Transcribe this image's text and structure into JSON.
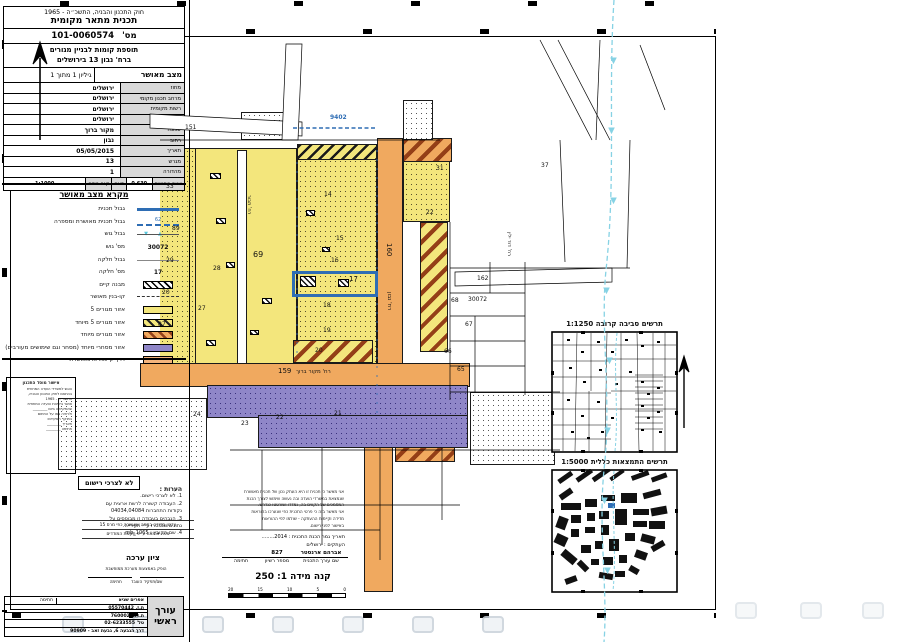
{
  "map_info": {
    "lines": [
      "מחוז :ירושלים",
      "נפה :ירושלים",
      "מקום : רחו' נבון,מס' 13",
      "גוש: 30072",
      "חלקה :17",
      "שטח מדוד : 0.110 ד'",
      "הוכן עבור : הבעלים"
    ]
  },
  "title_block": {
    "law": "חוק התכנון והבניה, התשכ״ה - 1965",
    "doc_type": "תכנית מתאר מקומית",
    "number_label": "מס'",
    "number": "101-0060574",
    "plan_name_1": "תוספת קומות לבניין מגורים",
    "plan_name_2": "ברח' נבון 13 בירושלים",
    "status": "מצב מאושר",
    "sheet": "גיליון 1 מתוך 1",
    "rows": [
      {
        "label": "מחוז",
        "value": "ירושלים"
      },
      {
        "label": "מרחב תכנון מקומי",
        "value": "ירושלים"
      },
      {
        "label": "רשות מקומית",
        "value": "ירושלים"
      },
      {
        "label": "ישוב",
        "value": "ירושלים"
      },
      {
        "label": "שכונה",
        "value": "מקור ברוך"
      },
      {
        "label": "רחוב",
        "value": "נבון"
      },
      {
        "label": "תאריך",
        "value": "05/05/2015"
      },
      {
        "label": "מגרש",
        "value": "13"
      },
      {
        "label": "מהדורה",
        "value": "1"
      }
    ],
    "area_label": "שטח התכנית",
    "area_value": "0.630",
    "area_unit": "דונם",
    "scale_label": "קנה מידה",
    "scale_value": "1:1000"
  },
  "legend": {
    "title": "מקרא מצב מאושר",
    "items": [
      {
        "s": "line-blue",
        "label": "גבול תכנית"
      },
      {
        "s": "dash-blue",
        "t": "62",
        "label": "גבול תכנית מאושרת ומספרה"
      },
      {
        "s": "gush",
        "t": "▲▼",
        "label": "גבול גוש"
      },
      {
        "s": "num",
        "t": "30072",
        "label": "מס' גוש"
      },
      {
        "s": "thin",
        "label": "גבול חלקה"
      },
      {
        "s": "num",
        "t": "17",
        "label": "מס' חלקה"
      },
      {
        "s": "box bldg",
        "label": "מבנה קיים"
      },
      {
        "s": "dashdot",
        "label": "קו-בנין מאושר"
      },
      {
        "s": "box y",
        "label": "אזור מגורים 5"
      },
      {
        "s": "box yh",
        "label": "אזור מגורים 5 מיוחד"
      },
      {
        "s": "box oh",
        "label": "אזור מגורים מיוחד"
      },
      {
        "s": "box p",
        "label": "אזור מסחרי מיוחד (מסחר וגם שימושים מעורבים)"
      },
      {
        "s": "box o",
        "label": "דרך קיימת או מאושרת"
      }
    ]
  },
  "stamp_box": {
    "title": "אישור מוסד התכנון",
    "lines": [
      "הוגש למשרדי הועדה המחוזית",
      "בהתאם לחוק התכנון והבניה,",
      "התשכ״ה - 1965",
      "אושר בישיבת הועדה המחוזית",
      "שהתקיימה ביום ________",
      "ולראיה באו על החתום",
      "בתוקף תפקידם:",
      "תאריך ________",
      "חתימה ________"
    ]
  },
  "notes": {
    "title": "הערות :",
    "lines": [
      "1. לא לצרכי רישום.",
      "2. העבודה קשורה לרשת ארצית עם",
      "נקודות התחברות 04034,04084",
      "3. הגבהים בעבודה זו מבוססים על",
      "נתונים שנמסרו ע״י העירייה.",
      "4. שם הקובץ : mb_1065"
    ]
  },
  "editor_table": {
    "header": "עורך ראשי",
    "name": "אפרים שגיא",
    "signature_label": "חתימה",
    "rows": [
      "ת.ז. 05570442",
      "ת.ד. 7600020",
      "טל' 02-6233555",
      "דרך הגבעה 6, גבעת זאב - 90909"
    ]
  },
  "insets": {
    "near_title": "תרשים סביבה קרובה 1:1250",
    "general_title": "תרשים התמצאות כללית 1:5000"
  },
  "no_registration": "לא לצרכי רישום",
  "survey_update": {
    "line1": "עדכון מדידה במפה שאושרה כפי מרס 15",
    "line2": "מפה אומתה ע״פ תקנות המודדים"
  },
  "zion": {
    "title": "ציון ערכה",
    "note": "הופק באמצעות מערכת ממוחשבת",
    "col_right": "שם/תפקיד העובד",
    "col_left": "חתימה"
  },
  "certification": {
    "lines": [
      "אני מאשר כי תכנית זו היא העתק נכון של תכנית מאושרת",
      "שנמצאת במשרדי הועדה ובה נעשה שימוש לצורך הכנת",
      "המסמכים של הקווים בה, נמדדו ושורטטו כנדרש.",
      "אני מאשר בזה כי פרטי התכנית כפי שנערכו בהוראות",
      "מדידה וקיימות ההעתקה - שולמו לפי ההוראות",
      "באישור לפני רישום."
    ]
  },
  "prep": {
    "date_label": "תאריך גמר הכנת התכנית :",
    "date_value": "2014........",
    "copies_label": "העתקים :",
    "copies_value": "ירושלים"
  },
  "sig": {
    "name": "אברהם ארנסטר",
    "name_label": "שם עורך התכנית",
    "license": "827",
    "license_label": "מספר רשיון",
    "sign_label": "חתימה"
  },
  "scale": {
    "title": "קנה מידה 1: 250",
    "ticks": [
      "20",
      "15",
      "10",
      "5",
      "0"
    ]
  },
  "map": {
    "labels": [
      {
        "t": "151",
        "x": 185,
        "y": 125
      },
      {
        "t": "9402",
        "x": 330,
        "y": 115,
        "c": "blue"
      },
      {
        "t": "33",
        "x": 166,
        "y": 184
      },
      {
        "t": "89",
        "x": 172,
        "y": 226
      },
      {
        "t": "29",
        "x": 166,
        "y": 258
      },
      {
        "t": "20",
        "x": 162,
        "y": 290
      },
      {
        "t": "87",
        "x": 158,
        "y": 322
      },
      {
        "t": "28",
        "x": 213,
        "y": 266
      },
      {
        "t": "27",
        "x": 198,
        "y": 306
      },
      {
        "t": "69",
        "x": 253,
        "y": 252,
        "s": 8
      },
      {
        "t": "14",
        "x": 324,
        "y": 192
      },
      {
        "t": "15",
        "x": 336,
        "y": 236
      },
      {
        "t": "16",
        "x": 331,
        "y": 258
      },
      {
        "t": "17",
        "x": 349,
        "y": 276,
        "s": 7
      },
      {
        "t": "18",
        "x": 323,
        "y": 303
      },
      {
        "t": "19",
        "x": 323,
        "y": 328
      },
      {
        "t": "20",
        "x": 315,
        "y": 348
      },
      {
        "t": "22",
        "x": 426,
        "y": 210
      },
      {
        "t": "31",
        "x": 436,
        "y": 166
      },
      {
        "t": "37",
        "x": 541,
        "y": 163
      },
      {
        "t": "162",
        "x": 477,
        "y": 276
      },
      {
        "t": "68",
        "x": 451,
        "y": 298
      },
      {
        "t": "30072",
        "x": 468,
        "y": 297
      },
      {
        "t": "67",
        "x": 465,
        "y": 322
      },
      {
        "t": "66",
        "x": 444,
        "y": 349
      },
      {
        "t": "65",
        "x": 457,
        "y": 367
      },
      {
        "t": "160",
        "x": 392,
        "y": 243,
        "rot": true,
        "s": 7
      },
      {
        "t": "רח' נבון",
        "x": 392,
        "y": 292,
        "rot": true,
        "s": 5.5
      },
      {
        "t": "רח' דוד ילין",
        "x": 512,
        "y": 232,
        "rot": true,
        "s": 5
      },
      {
        "t": "רח' תבור",
        "x": 252,
        "y": 195,
        "rot": true,
        "s": 5
      },
      {
        "t": "159",
        "x": 278,
        "y": 368,
        "s": 7
      },
      {
        "t": "רח' מקור ברוך",
        "x": 296,
        "y": 369,
        "s": 5.5
      },
      {
        "t": "21",
        "x": 334,
        "y": 411
      },
      {
        "t": "22",
        "x": 276,
        "y": 415
      },
      {
        "t": "23",
        "x": 241,
        "y": 421
      },
      {
        "t": "24",
        "x": 193,
        "y": 412
      }
    ],
    "buildings": [
      [
        300,
        276,
        16,
        11
      ],
      [
        338,
        279,
        11,
        8
      ],
      [
        210,
        173,
        11,
        6
      ],
      [
        216,
        218,
        10,
        6
      ],
      [
        226,
        262,
        9,
        6
      ],
      [
        262,
        298,
        10,
        6
      ],
      [
        306,
        210,
        9,
        6
      ],
      [
        322,
        247,
        8,
        5
      ],
      [
        206,
        340,
        10,
        6
      ],
      [
        250,
        330,
        9,
        5
      ]
    ]
  }
}
